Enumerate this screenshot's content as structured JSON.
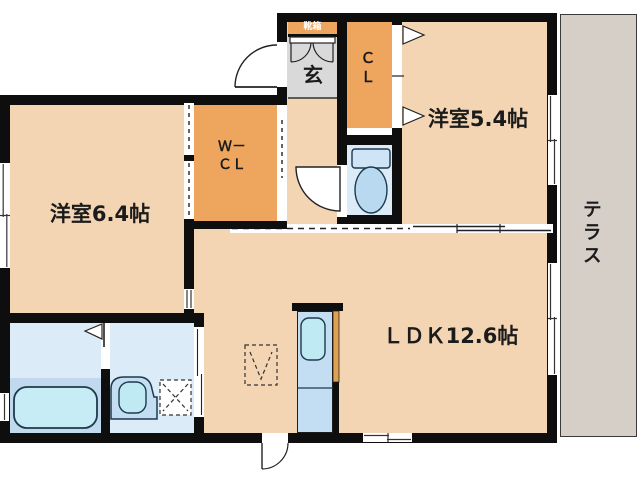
{
  "floorplan": {
    "title": "apartment-floor-plan",
    "rooms": {
      "bedroom_64": {
        "label": "洋室6.4帖"
      },
      "bedroom_54": {
        "label": "洋室5.4帖"
      },
      "ldk": {
        "label": "ＬＤＫ12.6帖"
      },
      "entrance": {
        "label": "玄"
      },
      "shoe_box": {
        "label": "靴箱"
      },
      "closet": {
        "line1": "Ｃ",
        "line2": "Ｌ"
      },
      "walk_in_closet": {
        "line1": "Ｗ－",
        "line2": "ＣＬ"
      },
      "terrace": {
        "label": "テラス"
      }
    },
    "fixtures": [
      "bathtub",
      "washbasin",
      "washing-machine-space",
      "toilet",
      "kitchen-sink",
      "refrigerator-space",
      "shoe-cabinet"
    ],
    "colors": {
      "wall": "#0e0e0e",
      "room_floor": "#f3d4b3",
      "closet_floor": "#eea55e",
      "entrance_floor": "#d9d9d9",
      "wet_area_floor": "#dcebf8",
      "bath_lower_floor": "#c0d9ee",
      "kitchen_counter": "#c3ddf2",
      "fixture_fill": "#c8ecf6",
      "terrace": "#d6cfc8",
      "text": "#1b1b1b"
    }
  }
}
